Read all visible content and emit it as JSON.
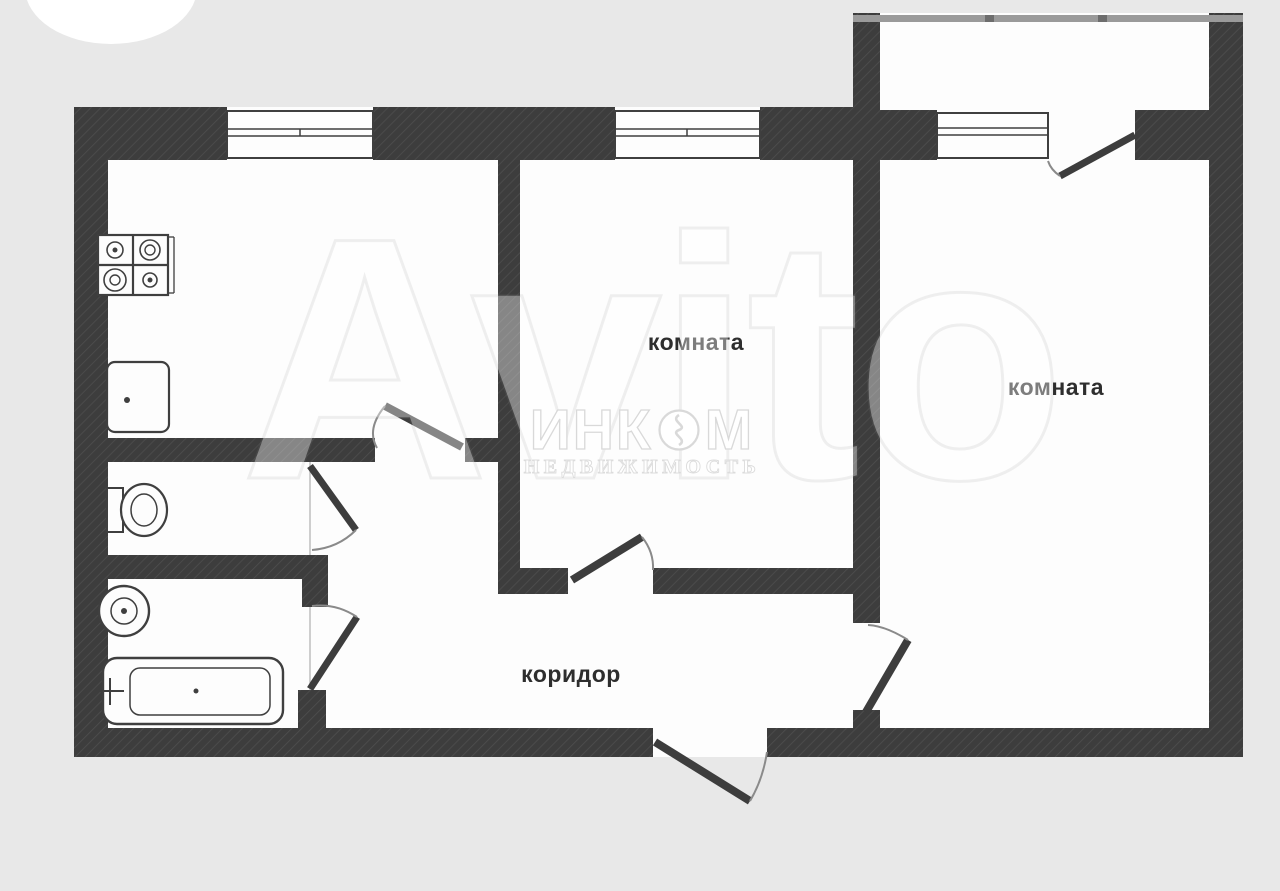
{
  "page": {
    "background_color": "#e8e8e8",
    "paper_color": "#fdfdfd"
  },
  "floor_plan": {
    "type": "apartment-floor-plan",
    "labels": {
      "room_center": "комната",
      "room_right": "комната",
      "corridor": "коридор"
    },
    "rooms": [
      {
        "name": "kitchen",
        "label": ""
      },
      {
        "name": "room-center",
        "label": "комната"
      },
      {
        "name": "room-right",
        "label": "комната"
      },
      {
        "name": "corridor",
        "label": "коридор"
      },
      {
        "name": "wc",
        "label": ""
      },
      {
        "name": "bathroom",
        "label": ""
      },
      {
        "name": "balcony",
        "label": ""
      }
    ],
    "fixtures": [
      "stove-icon",
      "kitchen-sink-icon",
      "toilet-icon",
      "wash-basin-icon",
      "bathtub-icon"
    ],
    "features": [
      "kitchen-window",
      "room-center-window",
      "balcony-window",
      "balcony-door",
      "entrance-door"
    ],
    "colors": {
      "wall": "#3d3d3d",
      "wall_hatch": "#4d4d4d",
      "fixture_line": "#3f3f3f",
      "label_text": "#2e2e2e",
      "balcony_rail": "#9a9a9a",
      "door_arc": "#8a8a8a"
    }
  },
  "watermarks": {
    "incom": {
      "brand_prefix": "ИНК",
      "brand_suffix": "М",
      "logo": "incom-circle-logo",
      "subtitle": "НЕДВИЖИМОСТЬ"
    },
    "background_brand": "Avito"
  }
}
